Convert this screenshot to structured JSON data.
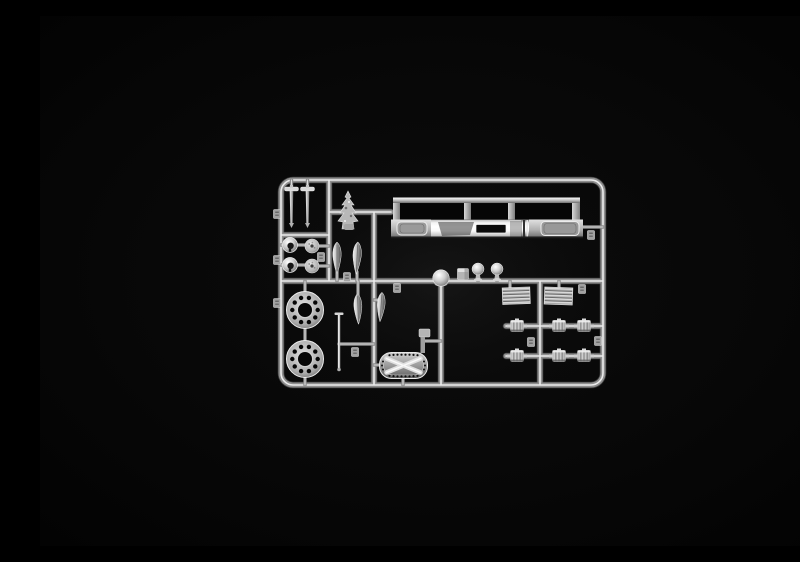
{
  "scene": {
    "type": "product-photograph",
    "description": "Chrome-plated plastic model kit sprue (parts runner) photographed on a plain black background",
    "background_color": "#050505",
    "finish": "mirror chrome silver",
    "colors": {
      "chrome_highlight": "#f2f2f2",
      "chrome_mid": "#9a9a9a",
      "chrome_shadow": "#4a4a4a",
      "background": "#050505"
    },
    "runner": {
      "shape": "rounded rectangle frame with internal cross rails",
      "orientation": "landscape, centered in frame"
    },
    "parts": [
      {
        "name": "front-bumper-assembly",
        "count": 1,
        "note": "long chrome bumper with three open windows and two step panels"
      },
      {
        "name": "wheel-hub-ring",
        "count": 2,
        "note": "large rings with ten drilled holes"
      },
      {
        "name": "t-shaped-rod",
        "count": 2
      },
      {
        "name": "ornament-cluster",
        "count": 1,
        "note": "small tree-shaped part"
      },
      {
        "name": "headlight-bucket",
        "count": 2
      },
      {
        "name": "horn-disc",
        "count": 2
      },
      {
        "name": "mirror-blade",
        "count": 4,
        "note": "elongated teardrop blades"
      },
      {
        "name": "ball-lamp",
        "count": 2
      },
      {
        "name": "dome-cap",
        "count": 1
      },
      {
        "name": "cube-block",
        "count": 1
      },
      {
        "name": "tread-plate",
        "count": 2,
        "note": "ribbed rectangular step plates"
      },
      {
        "name": "ribbed-drum",
        "count": 6,
        "note": "small drums with side axles in two rows of three"
      },
      {
        "name": "catwalk-plate",
        "count": 1,
        "note": "oval perforated plate with X cross brace"
      },
      {
        "name": "thin-rod",
        "count": 1
      },
      {
        "name": "small-bracket",
        "count": 1
      },
      {
        "name": "number-tag",
        "count": 11,
        "note": "small molded part-number squares on rails"
      }
    ]
  }
}
